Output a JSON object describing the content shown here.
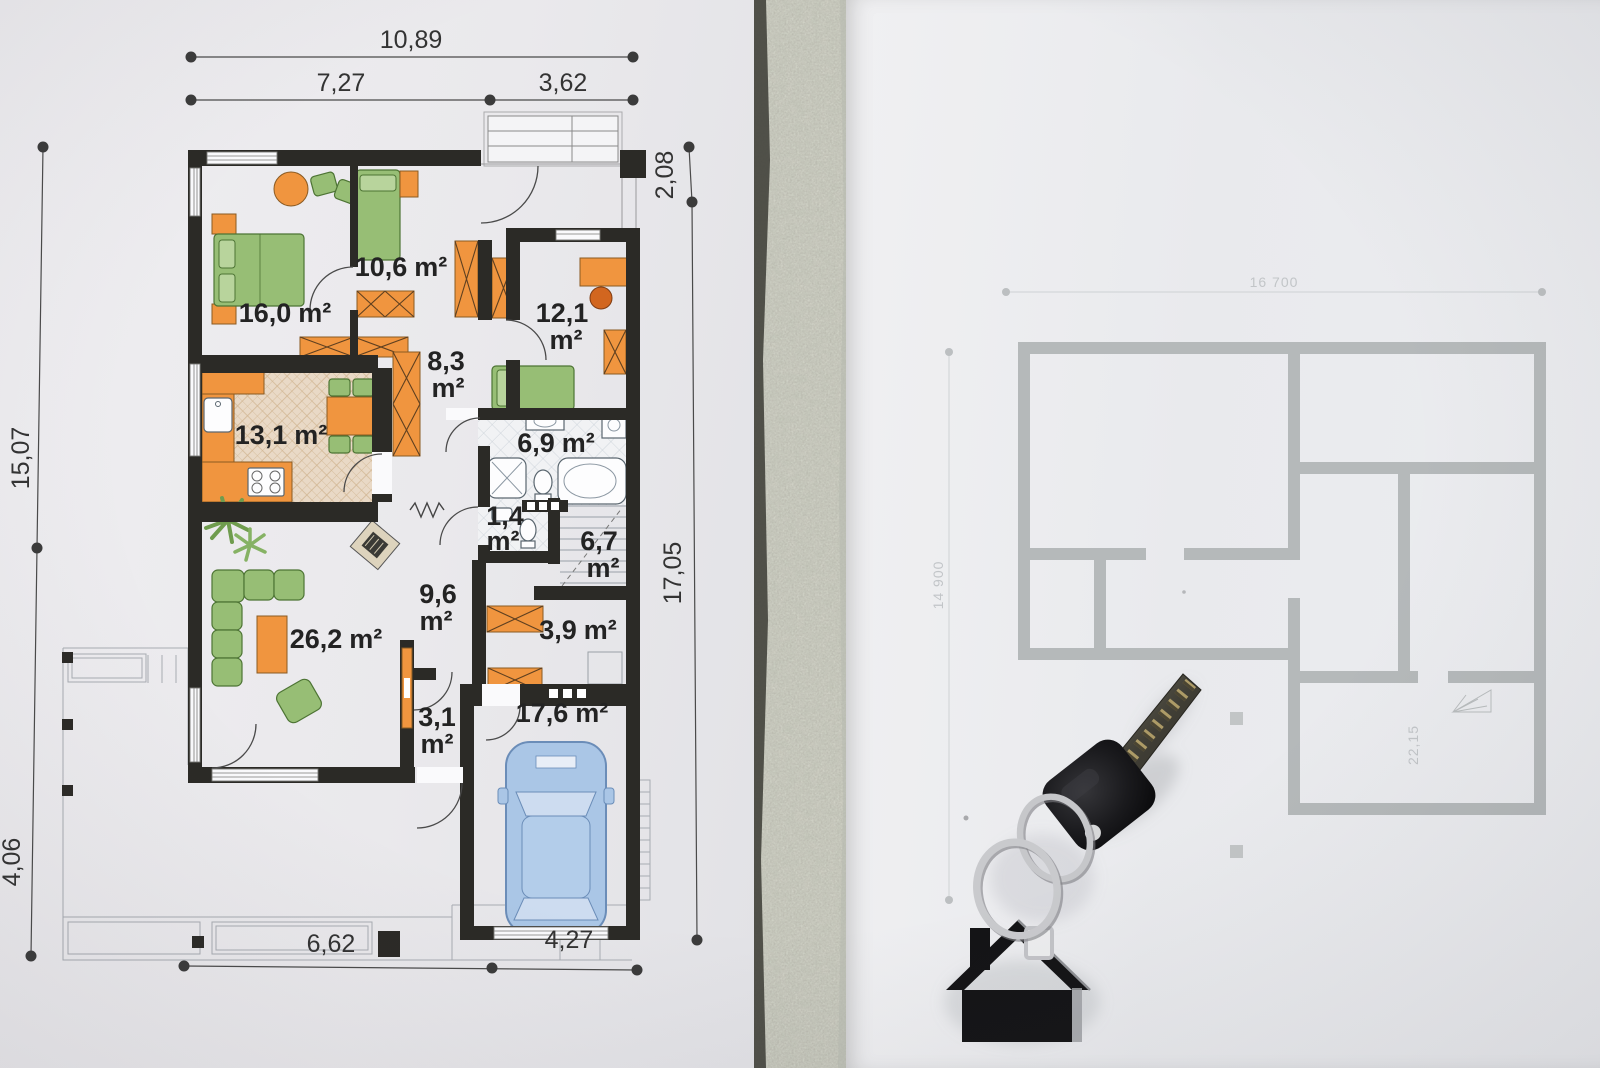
{
  "floor_plan": {
    "dimensions": {
      "top_total": "10,89",
      "top_left": "7,27",
      "top_right": "3,62",
      "left_upper": "15,07",
      "left_lower": "4,06",
      "right_upper": "2,08",
      "right_lower": "17,05",
      "bottom_left": "6,62",
      "bottom_right": "4,27"
    },
    "rooms": {
      "bedroom1": {
        "value": "16,0",
        "unit": "m²"
      },
      "bedroom2": {
        "value": "10,6",
        "unit": "m²"
      },
      "bedroom3": {
        "value": "12,1",
        "unit": "m²"
      },
      "hall": {
        "value": "8,3",
        "unit": "m²"
      },
      "kitchen": {
        "value": "13,1",
        "unit": "m²"
      },
      "bathroom": {
        "value": "6,9",
        "unit": "m²"
      },
      "wc": {
        "value": "1,4",
        "unit": "m²"
      },
      "staircase": {
        "value": "6,7",
        "unit": "m²"
      },
      "corridor": {
        "value": "9,6",
        "unit": "m²"
      },
      "storage": {
        "value": "3,9",
        "unit": "m²"
      },
      "living_room": {
        "value": "26,2",
        "unit": "m²"
      },
      "entry": {
        "value": "3,1",
        "unit": "m²"
      },
      "garage": {
        "value": "17,6",
        "unit": "m²"
      }
    }
  },
  "background_plan": {
    "dim_top": "16 700",
    "dim_left": "14 900",
    "room_area": "22,15"
  },
  "colors": {
    "walls": "#2b2a26",
    "furniture_orange": "#f0953f",
    "furniture_green": "#97be75",
    "kitchen_floor": "#e9d9c6",
    "car": "#aac6e6",
    "faded_walls": "#b5b9ba",
    "concrete": "#c9cdc0",
    "paper": "#ecebee"
  }
}
